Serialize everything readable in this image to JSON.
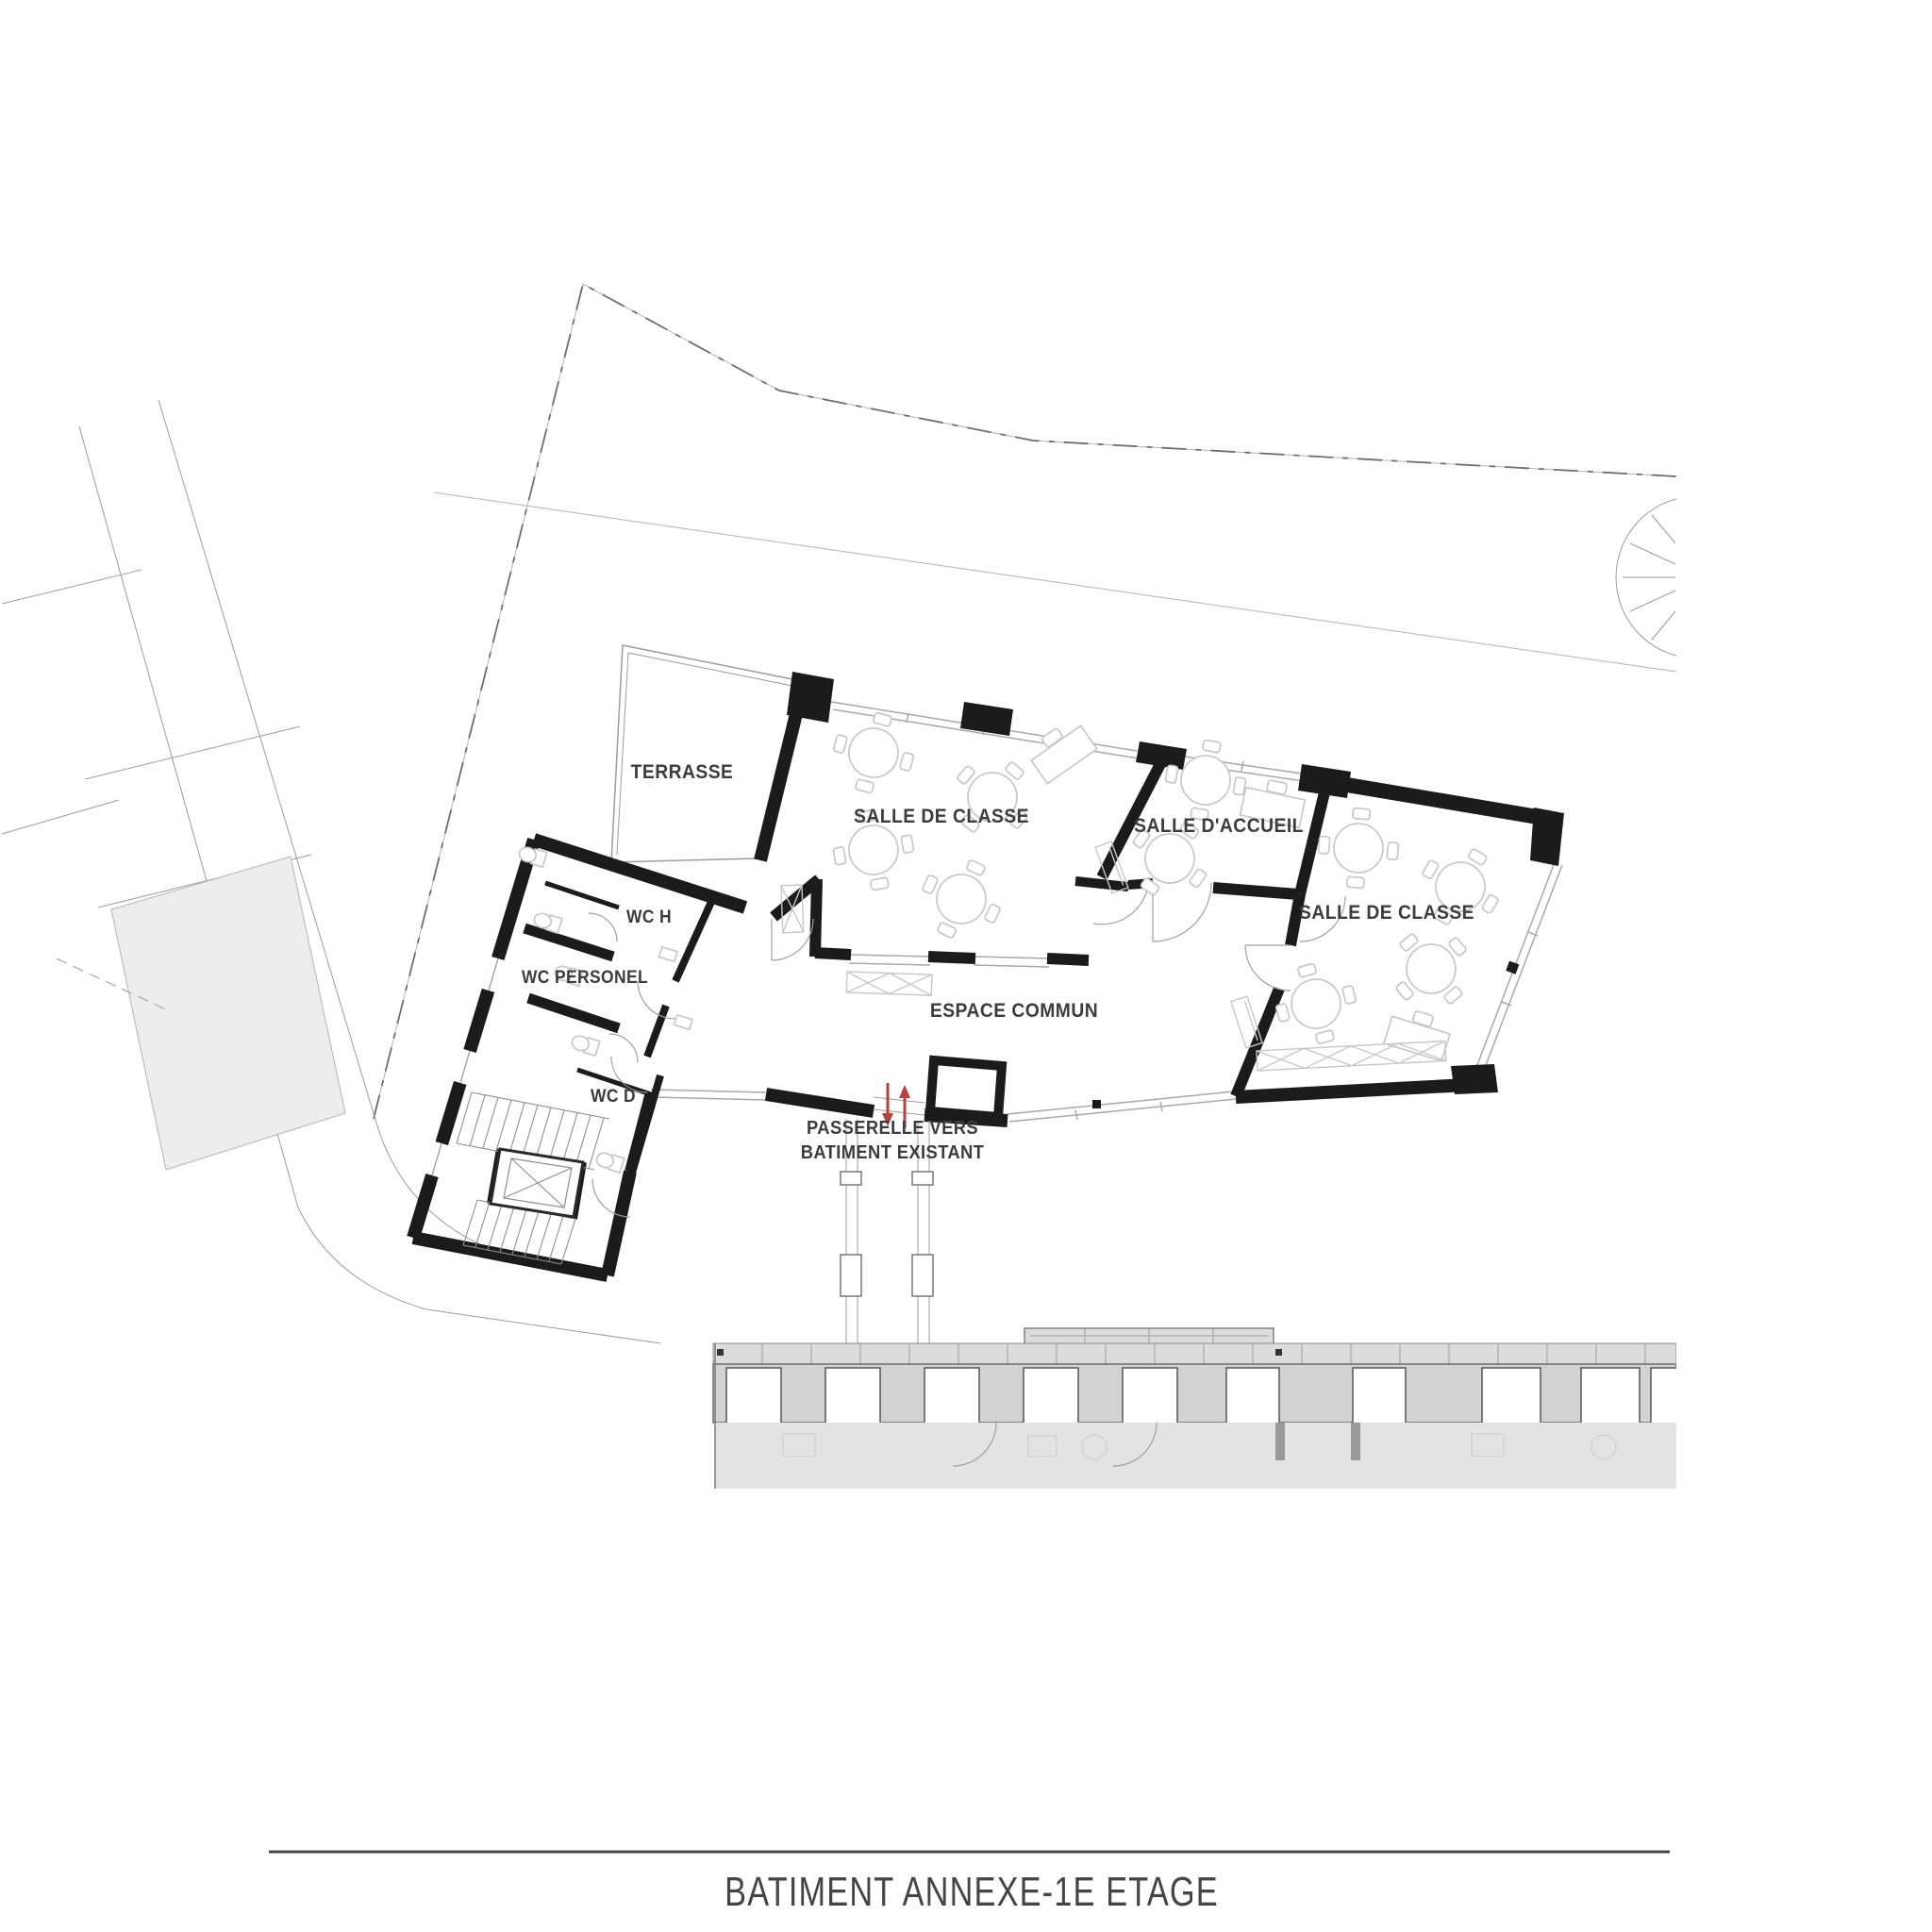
{
  "colors": {
    "wall": "#1b1b1b",
    "thin_line": "#9c9c9c",
    "site_line": "#6e6e6e",
    "window_line": "#a8a8a8",
    "furniture_line": "#c8c8c8",
    "label_color": "#3c3c3c",
    "title_color": "#454545",
    "red_arrow": "#b2453f",
    "neighbor_fill": "#ededed",
    "existing_ledge": "#dcdcdc",
    "existing_facade": "#d2d2d2",
    "existing_interior": "#e3e3e3"
  },
  "plan": {
    "rooms": [
      {
        "label": "TERRASSE"
      },
      {
        "label": "SALLE DE CLASSE"
      },
      {
        "label": "SALLE D'ACCUEIL"
      },
      {
        "label": "SALLE DE CLASSE"
      },
      {
        "label": "ESPACE COMMUN"
      },
      {
        "label": "WC H"
      },
      {
        "label": "WC PERSONEL"
      },
      {
        "label": "WC D"
      }
    ],
    "annotations": {
      "passerelle_line1": "PASSERELLE VERS",
      "passerelle_line2": "BATIMENT EXISTANT"
    }
  },
  "title_block": {
    "title": "BATIMENT ANNEXE-1E ETAGE"
  }
}
